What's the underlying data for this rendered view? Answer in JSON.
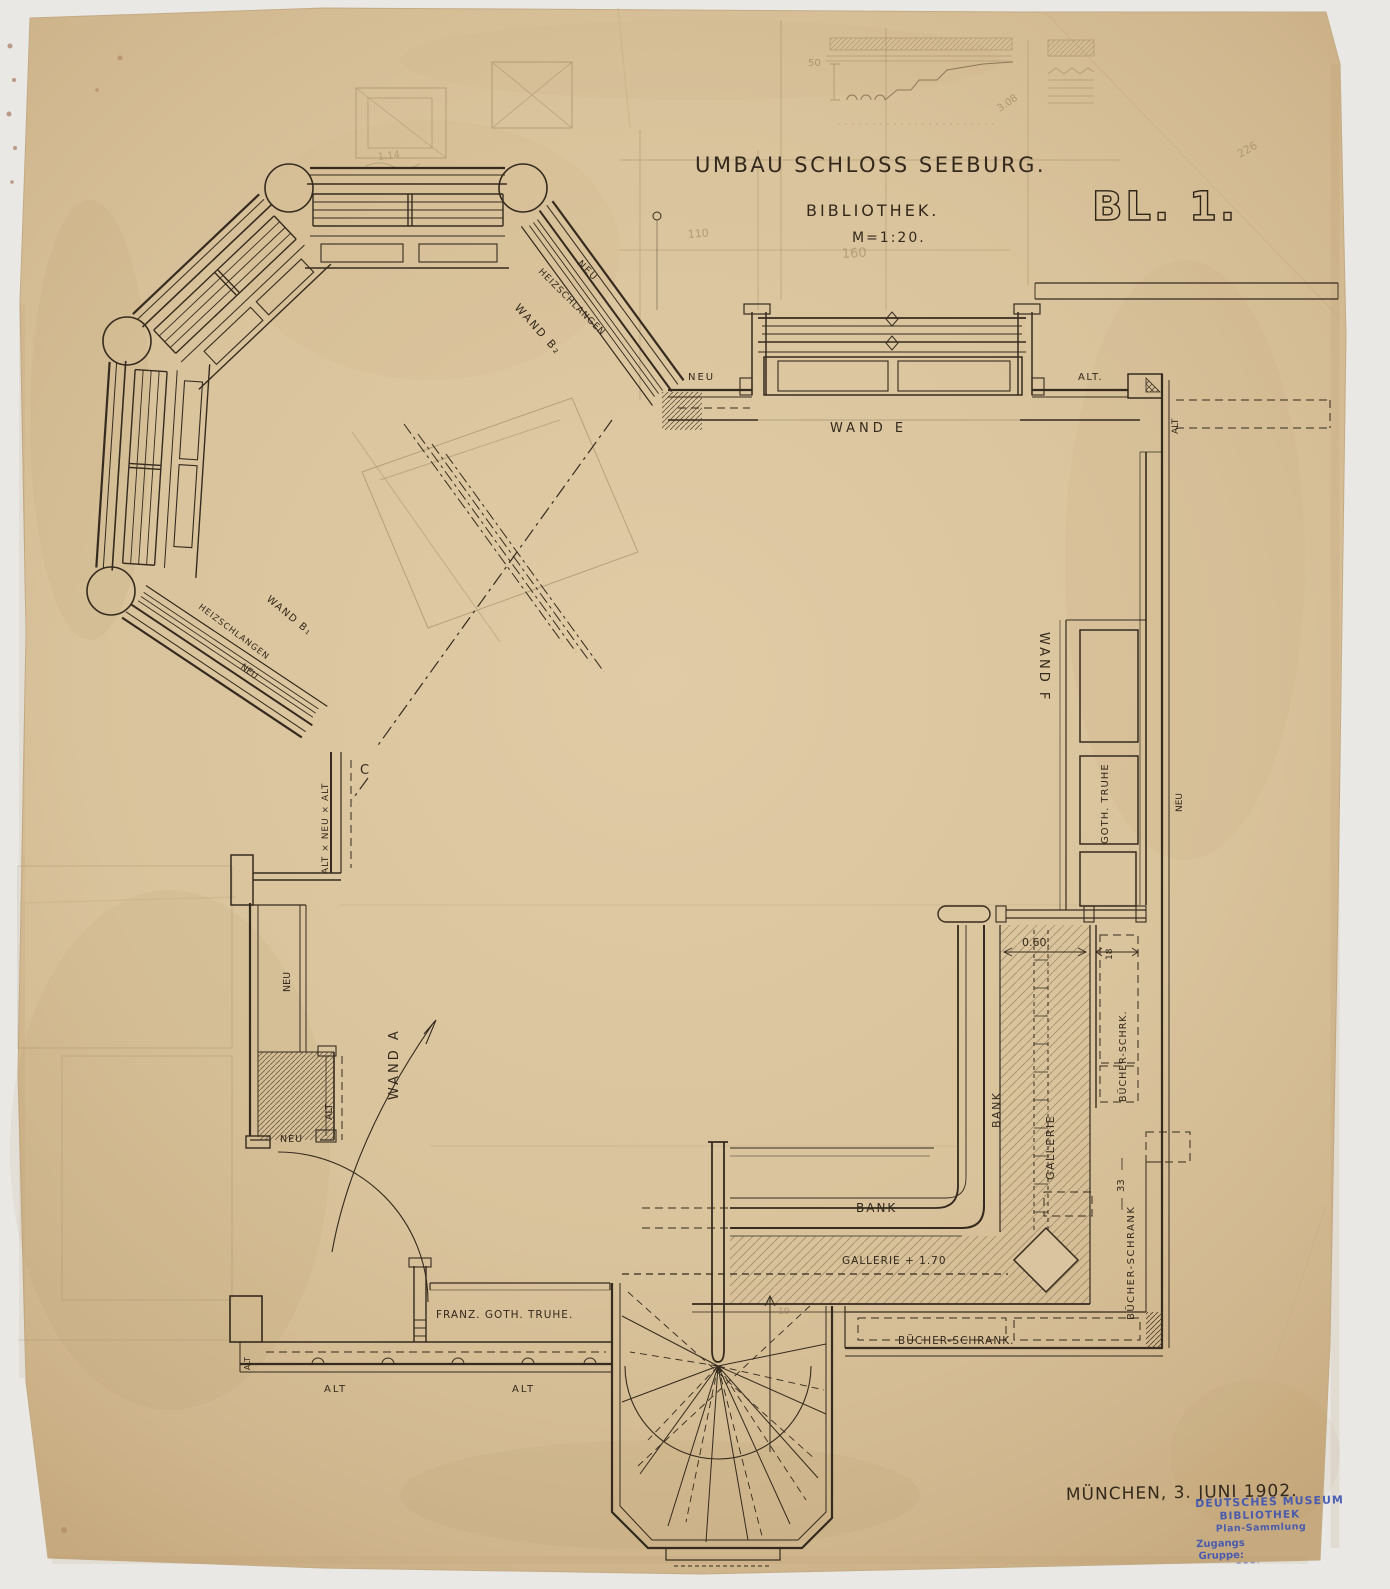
{
  "title": {
    "line1": "UMBAU SCHLOSS SEEBURG.",
    "line2": "BIBLIOTHEK.",
    "line3": "M=1:20.",
    "sheet_number": "BL. 1."
  },
  "footer": {
    "date_place": "MÜNCHEN, 3. JUNI 1902."
  },
  "stamp": {
    "line1": "DEUTSCHES MUSEUM",
    "line2": "BIBLIOTHEK",
    "line3": "Plan-Sammlung",
    "line4": "Zugangs",
    "line5": "Gruppe:"
  },
  "walls": {
    "wand_a": "WAND A",
    "wand_b1": "WAND B₁",
    "wand_b2": "WAND B₂",
    "wand_e": "WAND E",
    "wand_f": "WAND F",
    "section_c": "C"
  },
  "annotations": {
    "heizschlangen_b1": "HEIZSCHLANGEN",
    "neu_b1": "NEU",
    "heizschlangen_b2": "HEIZSCHLANGEN",
    "neu_b2": "NEU",
    "neu_wand_e": "NEU",
    "alt_wand_e": "ALT.",
    "alt_right_corner": "ALT",
    "neu_wand_f": "NEU",
    "alt_neu_alt": "ALT × NEU × ALT",
    "neu_left_upper": "NEU",
    "alt_left": "ALT",
    "neu_left_lower": "NEU",
    "alt_bottom_corner": "ALT",
    "alt_bottom_1": "ALT",
    "alt_bottom_2": "ALT"
  },
  "furniture": {
    "goth_truhe": "GOTH. TRUHE",
    "franz_goth_truhe": "FRANZ. GOTH. TRUHE.",
    "bank_bottom": "BANK",
    "bank_right": "BANK",
    "gallerie_right": "GALLERIE",
    "gallerie_height": "GALLERIE + 1.70",
    "buecher_schrank_bottom": "BÜCHER-SCHRANK.",
    "buecher_schrk_right": "BÜCHER-SCHRK.",
    "buecher_schrank_right": "BÜCHER-SCHRANK"
  },
  "dimensions": {
    "gallery_width": "0.60.",
    "shelf_depth": "18",
    "dim_33": "33",
    "sketch_50": "50",
    "pencil_110": "110",
    "pencil_160": "160",
    "pencil_114": "1.14",
    "pencil_308": "3.08",
    "pencil_226": "226",
    "pencil_10": "10"
  },
  "colors": {
    "paper": "#d9c39e",
    "ink": "#33291c",
    "pencil": "#8f7b57",
    "stamp_blue": "#3f55b2"
  }
}
